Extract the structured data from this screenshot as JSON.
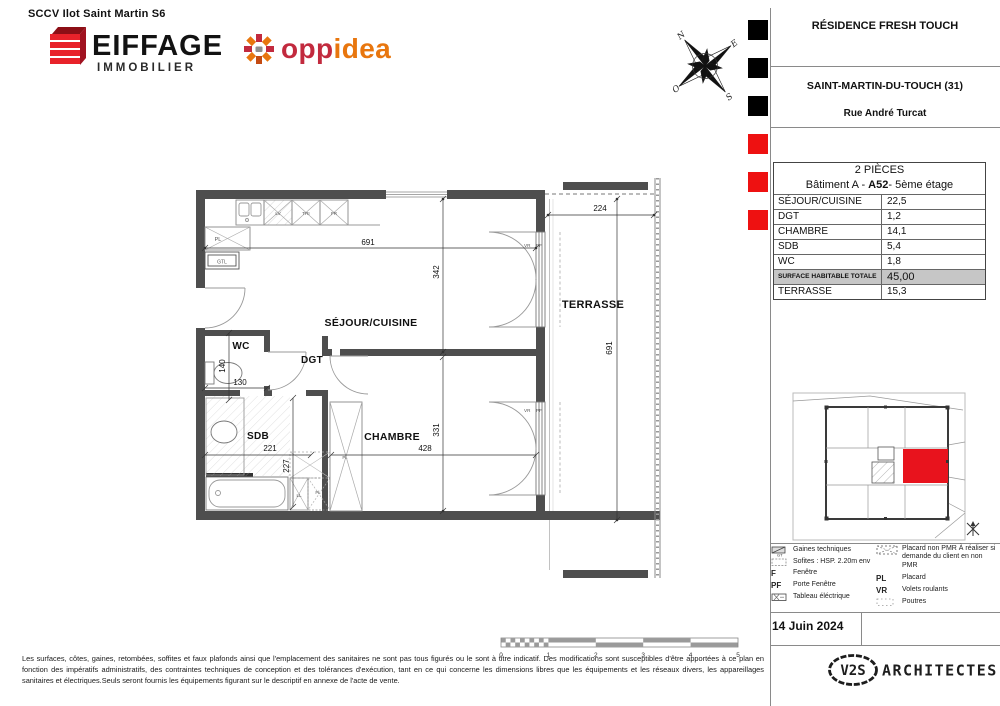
{
  "colors": {
    "accent_red": "#ee1111",
    "wall_gray": "#4e4e4e"
  },
  "header": {
    "project_company": "SCCV Ilot Saint Martin S6",
    "eiffage": {
      "name": "EIFFAGE",
      "sub": "IMMOBILIER"
    },
    "oppidea": {
      "left": "opp",
      "right": "idea"
    }
  },
  "title_block": {
    "residence": "RÉSIDENCE FRESH TOUCH",
    "city": "SAINT-MARTIN-DU-TOUCH (31)",
    "street": "Rue André Turcat"
  },
  "unit_table": {
    "type_label": "2 PIÈCES",
    "building_prefix": "Bâtiment A - ",
    "unit_id": "A52",
    "building_suffix": "- 5ème étage",
    "rows": [
      {
        "label": "SÉJOUR/CUISINE",
        "value": "22,5"
      },
      {
        "label": "DGT",
        "value": "1,2"
      },
      {
        "label": "CHAMBRE",
        "value": "14,1"
      },
      {
        "label": "SDB",
        "value": "5,4"
      },
      {
        "label": "WC",
        "value": "1,8"
      }
    ],
    "total": {
      "label": "SURFACE HABITABLE TOTALE",
      "value": "45,00"
    },
    "terrace": {
      "label": "TERRASSE",
      "value": "15,3"
    }
  },
  "plan": {
    "rooms": {
      "sejour": "SÉJOUR/CUISINE",
      "wc": "WC",
      "dgt": "DGT",
      "sdb": "SDB",
      "chambre": "CHAMBRE",
      "terrasse": "TERRASSE"
    },
    "dims": {
      "top_width": "691",
      "sejour_h": "342",
      "chambre_h": "331",
      "chambre_w": "428",
      "sdb_w": "221",
      "sdb_h": "227",
      "wc_h": "140",
      "wc_w": "130",
      "terrace_w": "224",
      "terrace_h": "691"
    },
    "labels": {
      "lv": "LV",
      "tri": "TRI",
      "fr": "FR",
      "pl": "PL",
      "gtl": "GTL",
      "ll": "LL",
      "pl_dot": "Pl.",
      "vr": "VR",
      "pf": "PF"
    },
    "compass": {
      "n": "N",
      "e": "E",
      "s": "S",
      "o": "O"
    }
  },
  "legend": {
    "left": [
      {
        "label": "Gaines techniques"
      },
      {
        "label": "Sofites : HSP. 2.20m env"
      },
      {
        "abbr": "F",
        "label": "Fenêtre"
      },
      {
        "abbr": "PF",
        "label": "Porte Fenêtre"
      },
      {
        "label": "Tableau éléctrique"
      }
    ],
    "right": [
      {
        "label": "Placard non PMR À réaliser  si demande du client en non PMR"
      },
      {
        "abbr": "PL",
        "label": "Placard"
      },
      {
        "abbr": "VR",
        "label": "Volets roulants"
      },
      {
        "label": "Poutres"
      }
    ],
    "gt_tag": "GT"
  },
  "date": "14 Juin  2024",
  "architect": {
    "logo": "V2S",
    "name": "ARCHITECTES"
  },
  "scale_bar": {
    "ticks": [
      "0",
      "1",
      "2",
      "3",
      "4",
      "5"
    ]
  },
  "disclaimer": "Les surfaces, côtes, gaines, retombées, soffites et faux plafonds ainsi que l'emplacement des sanitaires ne sont pas tous figurés ou le sont à titre indicatif. Des modifications sont susceptibles d'être apportées à ce plan en fonction des impératifs administratifs, des contraintes techniques de conception et des tolérances d'exécution, tant en ce qui concerne les dimensions libres que les équipements et les réseaux divers, les appareillages sanitaires et électriques.Seuls seront fournis les équipements figurant sur le descriptif en annexe de l'acte de vente."
}
